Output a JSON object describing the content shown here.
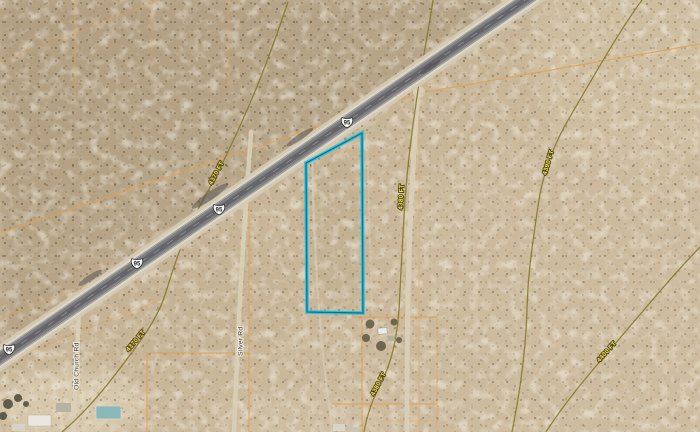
{
  "map": {
    "view": "Satellite",
    "highway": {
      "shield_label": "95"
    },
    "elevation_labels": [
      {
        "text": "4370 FT"
      },
      {
        "text": "4380 FT"
      },
      {
        "text": "4390 FT"
      },
      {
        "text": "4400 FT"
      },
      {
        "text": "4370 FT"
      },
      {
        "text": "4380 FT"
      }
    ],
    "road_labels": [
      {
        "text": "Old Church Rd"
      },
      {
        "text": "Silver Rd"
      }
    ],
    "colors": {
      "parcel_outline": "#2fbfdd",
      "boundary_line": "#dfa257",
      "contour_line": "#857a28",
      "elevation_label_text": "#ffe852",
      "asphalt": "#7f8082",
      "sand_base": "#c6b296"
    }
  }
}
